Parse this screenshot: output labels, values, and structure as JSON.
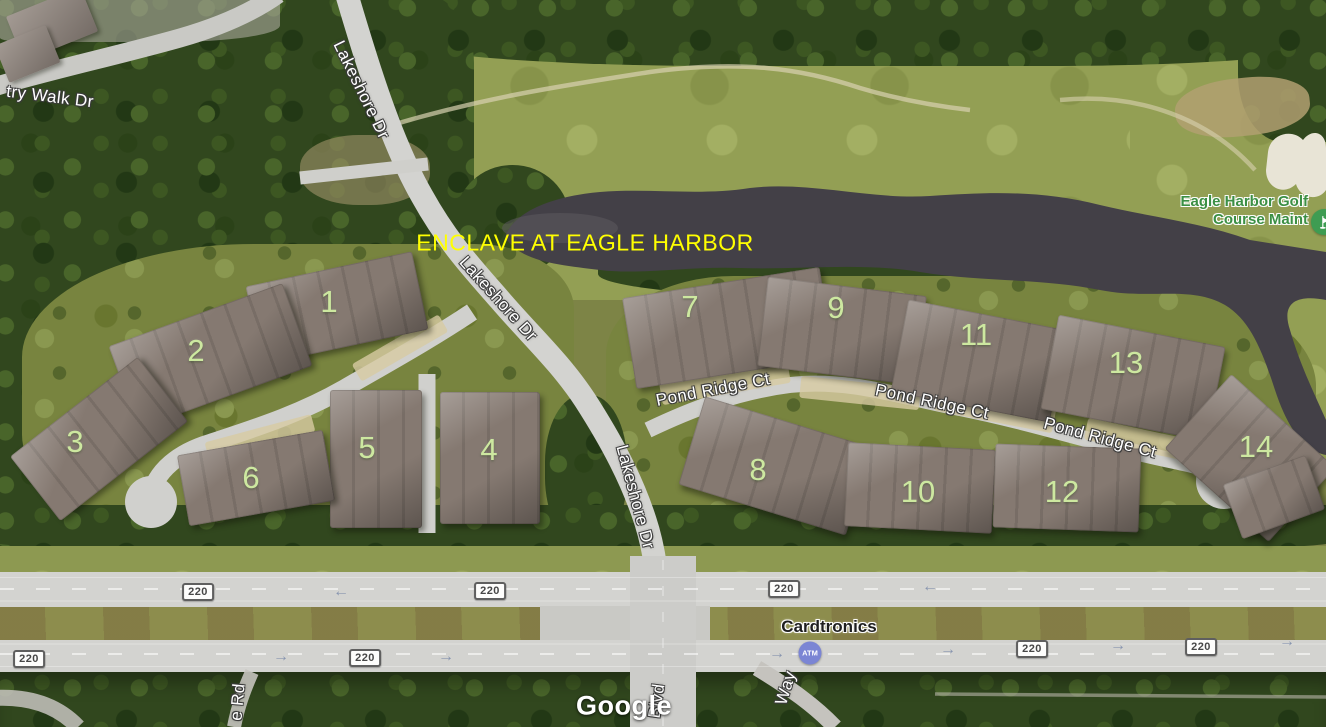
{
  "map": {
    "provider_watermark": "Google",
    "community_overlay": "ENCLAVE AT EAGLE HARBOR",
    "building_numbers": [
      "1",
      "2",
      "3",
      "4",
      "5",
      "6",
      "7",
      "8",
      "9",
      "10",
      "11",
      "12",
      "13",
      "14"
    ],
    "road_labels": {
      "lakeshore": "Lakeshore Dr",
      "pond_ridge": "Pond Ridge Ct",
      "country_walk_partial": "try Walk Dr",
      "rd_partial": "e Rd",
      "blvd_partial": "Blvd",
      "way_partial": "Way"
    },
    "route_shield_label": "220",
    "pois": {
      "cardtronics": "Cardtronics",
      "atm_badge": "ATM",
      "golf_course_line1": "Eagle Harbor Golf",
      "golf_course_line2": "Course Maint"
    },
    "symbols": {
      "arrow_left": "←",
      "arrow_right": "→"
    },
    "colors": {
      "community_label": "#ffff00",
      "building_number": "#cde8a0",
      "golf_poi_text": "#3b8f44",
      "golf_poi_icon_bg": "#3e9c52",
      "atm_icon_bg": "#7b85d4",
      "road_label": "#ffffff",
      "business_label": "#1f1f1f",
      "water": "#444149"
    }
  }
}
